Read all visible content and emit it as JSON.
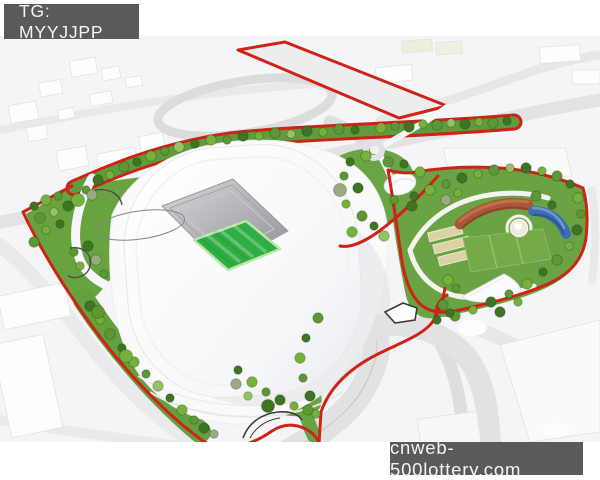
{
  "watermarks": {
    "top_left": "TG: MYYJJPP",
    "bottom_right": "cnweb-500lottery.com"
  },
  "colors": {
    "watermark_bg": "#595a5c",
    "watermark_text": "#f4f4f4",
    "boundary_red": "#cf2318",
    "pitch_green": "#2fae44",
    "lawn_green": "#67a33f",
    "terrace_brown": "#a8573a",
    "terrace_blue": "#3c6eb0",
    "court_beige": "#dbd2a6",
    "bowl_gray": "#b9babd",
    "stadium_white": "#fbfbfc",
    "road_gray": "#e3e3e6",
    "context_bg": "#f5f5f7",
    "canvas_white": "#ffffff"
  },
  "scene": {
    "description": "Aerial 3D rendering of a stadium masterplan: white stadium with sunken bowl and green football pitch, red site-boundary outlines, tree-lined landscaping, sports park with terraced gardens, courts, training pitches and pavilions, surrounded by pale city blocks and roads"
  }
}
